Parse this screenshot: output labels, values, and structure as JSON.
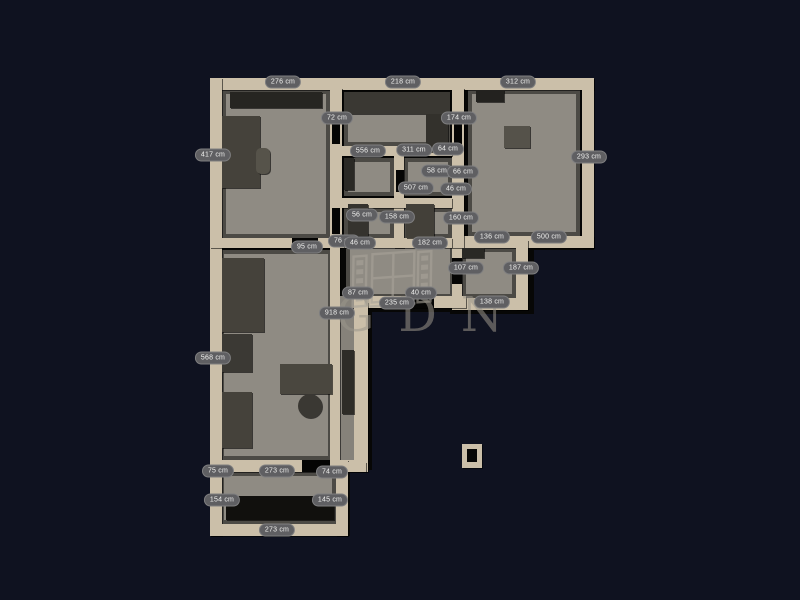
{
  "watermark": {
    "text": "GDN"
  },
  "colors": {
    "background": "#0f1220",
    "wall": "#cbbfa9",
    "floor": "#8f8b83",
    "floor_dark": "#86827a",
    "blackbase": "#070706",
    "furniture": "#45423b",
    "label_bg": "#5f5f62",
    "label_text": "#f0f0ee",
    "watermark": "#9b968b"
  },
  "labels": [
    {
      "text": "276 cm",
      "x": 283,
      "y": 82
    },
    {
      "text": "218 cm",
      "x": 403,
      "y": 82
    },
    {
      "text": "312 cm",
      "x": 518,
      "y": 82
    },
    {
      "text": "417 cm",
      "x": 213,
      "y": 155
    },
    {
      "text": "568 cm",
      "x": 213,
      "y": 358
    },
    {
      "text": "293 cm",
      "x": 589,
      "y": 157
    },
    {
      "text": "72 cm",
      "x": 337,
      "y": 118
    },
    {
      "text": "174 cm",
      "x": 459,
      "y": 118
    },
    {
      "text": "556 cm",
      "x": 368,
      "y": 151
    },
    {
      "text": "311 cm",
      "x": 414,
      "y": 150
    },
    {
      "text": "64 cm",
      "x": 448,
      "y": 149
    },
    {
      "text": "58 cm",
      "x": 437,
      "y": 171
    },
    {
      "text": "66 cm",
      "x": 463,
      "y": 172
    },
    {
      "text": "507 cm",
      "x": 416,
      "y": 188
    },
    {
      "text": "46 cm",
      "x": 456,
      "y": 189
    },
    {
      "text": "56 cm",
      "x": 362,
      "y": 215
    },
    {
      "text": "158 cm",
      "x": 397,
      "y": 217
    },
    {
      "text": "160 cm",
      "x": 461,
      "y": 218
    },
    {
      "text": "136 cm",
      "x": 492,
      "y": 237
    },
    {
      "text": "500 cm",
      "x": 549,
      "y": 237
    },
    {
      "text": "95 cm",
      "x": 307,
      "y": 247
    },
    {
      "text": "76 cm",
      "x": 344,
      "y": 241
    },
    {
      "text": "46 cm",
      "x": 360,
      "y": 243
    },
    {
      "text": "182 cm",
      "x": 430,
      "y": 243
    },
    {
      "text": "107 cm",
      "x": 466,
      "y": 268
    },
    {
      "text": "187 cm",
      "x": 521,
      "y": 268
    },
    {
      "text": "87 cm",
      "x": 358,
      "y": 293
    },
    {
      "text": "40 cm",
      "x": 421,
      "y": 293
    },
    {
      "text": "235 cm",
      "x": 397,
      "y": 303
    },
    {
      "text": "138 cm",
      "x": 492,
      "y": 302
    },
    {
      "text": "918 cm",
      "x": 337,
      "y": 313
    },
    {
      "text": "75 cm",
      "x": 218,
      "y": 471
    },
    {
      "text": "273 cm",
      "x": 277,
      "y": 471
    },
    {
      "text": "74 cm",
      "x": 332,
      "y": 472
    },
    {
      "text": "154 cm",
      "x": 222,
      "y": 500
    },
    {
      "text": "145 cm",
      "x": 330,
      "y": 500
    },
    {
      "text": "273 cm",
      "x": 277,
      "y": 530
    }
  ]
}
